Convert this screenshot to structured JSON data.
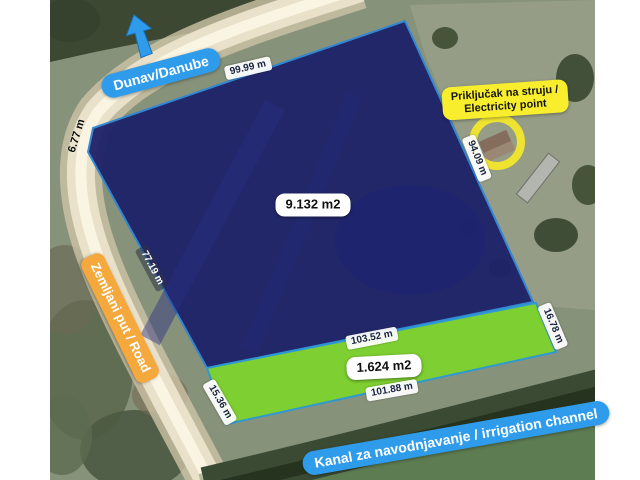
{
  "map": {
    "title_labels": {
      "river": "Dunav/Danube",
      "road": "Zemljani put / Road",
      "channel": "Kanal za navodnjavanje / irrigation channel",
      "electricity_line1": "Priključak na struju /",
      "electricity_line2": "Electricity point"
    },
    "plots": {
      "main": {
        "area": "9.132 m2",
        "fill": "#1c2169"
      },
      "strip": {
        "area": "1.624 m2",
        "fill": "#7ed22e"
      }
    },
    "measurements": {
      "main_top": "99.99 m",
      "main_bevel": "6.77 m",
      "main_left": "77.19 m",
      "main_right": "94.09 m",
      "strip_top": "103.52 m",
      "strip_bottom": "101.88 m",
      "strip_left": "15.36 m",
      "strip_right": "16.78 m"
    },
    "accent_colors": {
      "label_blue": "#2e9ceb",
      "label_orange": "#f5a93c",
      "label_yellow": "#f8ee2e",
      "ring_yellow": "#f3e72c",
      "plot_outline_blue": "#2d86d8"
    }
  }
}
